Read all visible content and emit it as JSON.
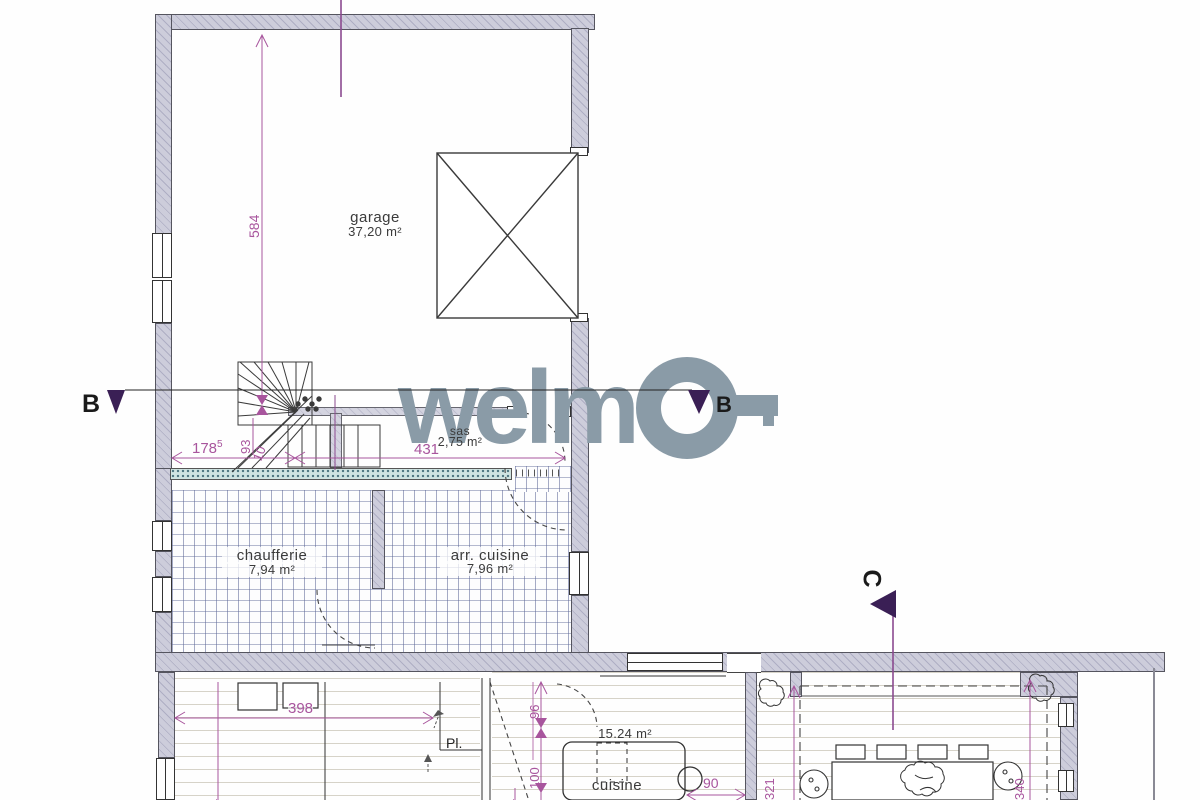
{
  "brand": {
    "name": "welmo",
    "word_prefix": "welm"
  },
  "section_markers": {
    "b_left": "B",
    "b_right": "B",
    "c": "C"
  },
  "rooms": {
    "garage": {
      "name": "garage",
      "area": "37,20 m²"
    },
    "chaufferie": {
      "name": "chaufferie",
      "area": "7,94 m²"
    },
    "arr_cuisine": {
      "name": "arr. cuisine",
      "area": "7,96 m²"
    },
    "sas": {
      "name": "sas",
      "area": "2,75 m²"
    },
    "cuisine": {
      "name": "cuisine",
      "area": "15.24 m²"
    }
  },
  "labels": {
    "placard": "Pl."
  },
  "dims": {
    "d584": "584",
    "d178": "178",
    "d178_sup": "5",
    "d93": "93",
    "d10": "10",
    "d431": "431",
    "d398": "398",
    "d96": "96",
    "d100": "100",
    "d90": "90",
    "d321": "321",
    "d340": "340",
    "partial_left": "51",
    "partial_mid": "51"
  },
  "colors": {
    "wall_fill": "#cdcddb",
    "dimension": "#a8559d",
    "section_line": "#8b4a8f",
    "marker_triangle": "#3a1f55",
    "logo_gray": "#8a9ba7",
    "tile_line": "#5c6696",
    "stipple_teal": "#cfe3e1"
  }
}
